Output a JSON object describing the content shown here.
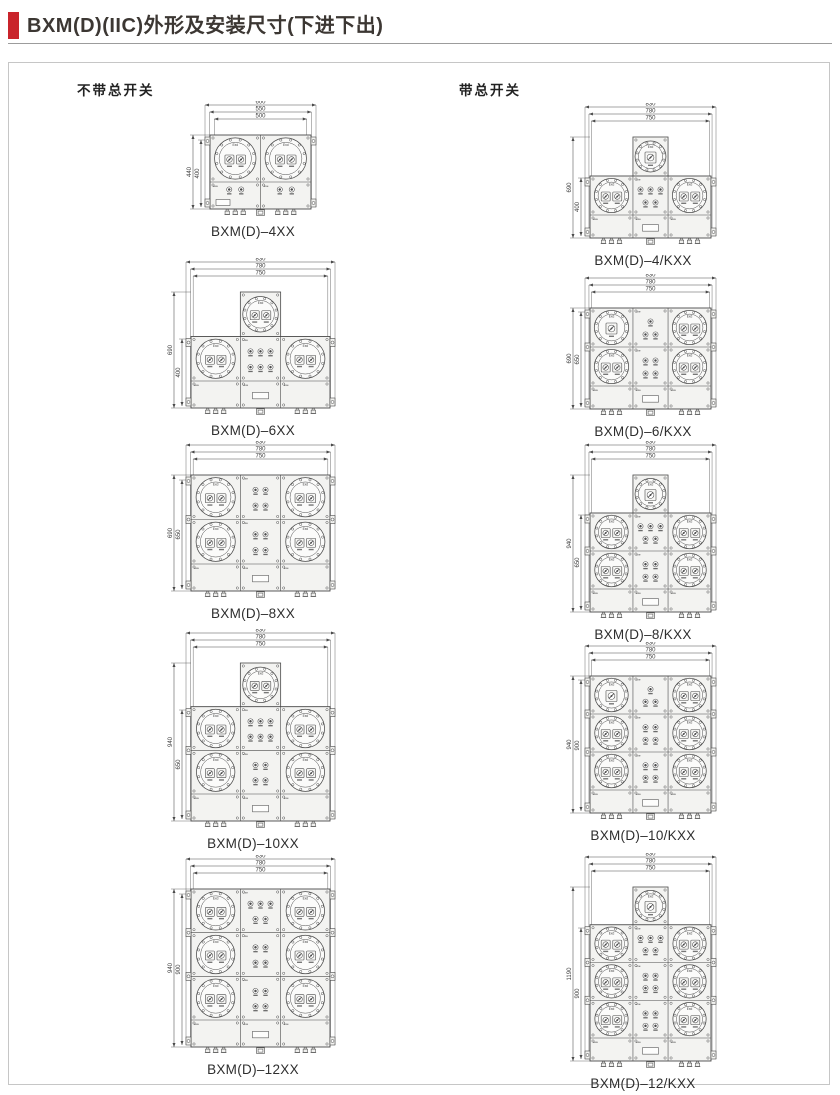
{
  "title": "BXM(D)(IIC)外形及安装尺寸(下进下出)",
  "accent_color": "#c9242b",
  "line_color": "#4a4a4a",
  "labels": {
    "flameproof": "Exd",
    "increased_safety": "Exe"
  },
  "columns": [
    {
      "header": "不带总开关",
      "figures": [
        {
          "id": "bxmd-4xx",
          "caption": "BXM(D)–4XX",
          "top_dims": [
            "600",
            "550",
            "500"
          ],
          "side_dims": [
            "440",
            "400"
          ],
          "rows": 1,
          "cols": 2,
          "top_circle": false,
          "single_main": null,
          "panels": []
        },
        {
          "id": "bxmd-6xx",
          "caption": "BXM(D)–6XX",
          "top_dims": [
            "830",
            "780",
            "750"
          ],
          "side_dims": [
            "690",
            "400"
          ],
          "rows": 1,
          "cols": 3,
          "top_circle": true,
          "single_main": null,
          "panels": [
            [
              3,
              3
            ]
          ]
        },
        {
          "id": "bxmd-8xx",
          "caption": "BXM(D)–8XX",
          "top_dims": [
            "830",
            "780",
            "750"
          ],
          "side_dims": [
            "690",
            "650"
          ],
          "rows": 2,
          "cols": 3,
          "top_circle": false,
          "single_main": null,
          "panels": [
            [
              2,
              2
            ],
            [
              2,
              2
            ]
          ]
        },
        {
          "id": "bxmd-10xx",
          "caption": "BXM(D)–10XX",
          "top_dims": [
            "830",
            "780",
            "750"
          ],
          "side_dims": [
            "940",
            "650"
          ],
          "rows": 2,
          "cols": 3,
          "top_circle": true,
          "single_main": null,
          "panels": [
            [
              3,
              3
            ],
            [
              2,
              2
            ]
          ]
        },
        {
          "id": "bxmd-12xx",
          "caption": "BXM(D)–12XX",
          "top_dims": [
            "830",
            "780",
            "750"
          ],
          "side_dims": [
            "940",
            "900"
          ],
          "rows": 3,
          "cols": 3,
          "top_circle": false,
          "single_main": null,
          "panels": [
            [
              3,
              2
            ],
            [
              2,
              2
            ],
            [
              2,
              2
            ]
          ]
        }
      ]
    },
    {
      "header": "带总开关",
      "figures": [
        {
          "id": "bxmd-4kxx",
          "caption": "BXM(D)–4/KXX",
          "top_dims": [
            "830",
            "780",
            "750"
          ],
          "side_dims": [
            "690",
            "400"
          ],
          "rows": 1,
          "cols": 3,
          "top_circle": true,
          "single_main": "top",
          "panels": [
            [
              3,
              2
            ]
          ]
        },
        {
          "id": "bxmd-6kxx",
          "caption": "BXM(D)–6/KXX",
          "top_dims": [
            "830",
            "780",
            "750"
          ],
          "side_dims": [
            "690",
            "650"
          ],
          "rows": 2,
          "cols": 3,
          "top_circle": false,
          "single_main": "first-left",
          "panels": [
            [
              1,
              2
            ],
            [
              2,
              2
            ]
          ]
        },
        {
          "id": "bxmd-8kxx",
          "caption": "BXM(D)–8/KXX",
          "top_dims": [
            "830",
            "780",
            "750"
          ],
          "side_dims": [
            "940",
            "650"
          ],
          "rows": 2,
          "cols": 3,
          "top_circle": true,
          "single_main": "top",
          "panels": [
            [
              3,
              2
            ],
            [
              2,
              2
            ]
          ]
        },
        {
          "id": "bxmd-10kxx",
          "caption": "BXM(D)–10/KXX",
          "top_dims": [
            "830",
            "780",
            "750"
          ],
          "side_dims": [
            "940",
            "900"
          ],
          "rows": 3,
          "cols": 3,
          "top_circle": false,
          "single_main": "first-left",
          "panels": [
            [
              1,
              2
            ],
            [
              2,
              2
            ],
            [
              2,
              2
            ]
          ]
        },
        {
          "id": "bxmd-12kxx",
          "caption": "BXM(D)–12/KXX",
          "top_dims": [
            "830",
            "780",
            "750"
          ],
          "side_dims": [
            "1190",
            "900"
          ],
          "rows": 3,
          "cols": 3,
          "top_circle": true,
          "single_main": "top",
          "panels": [
            [
              3,
              2
            ],
            [
              2,
              2
            ],
            [
              2,
              2
            ]
          ]
        }
      ]
    }
  ]
}
